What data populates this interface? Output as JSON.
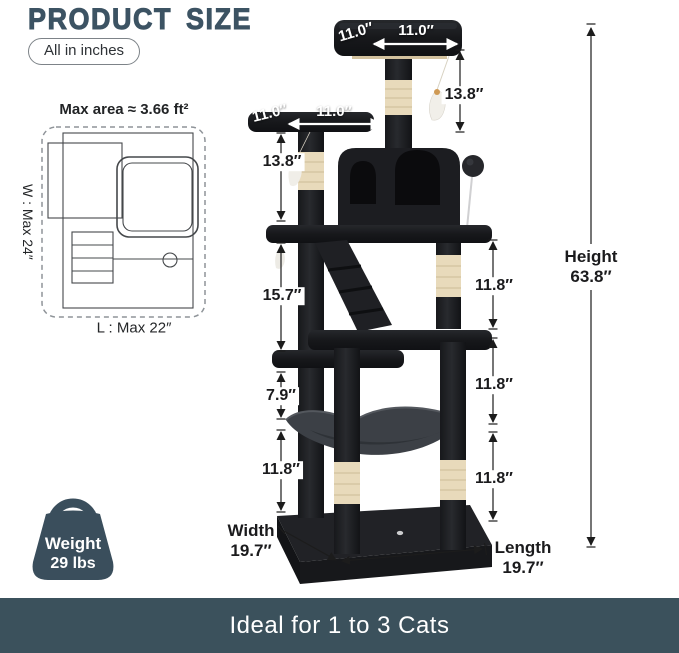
{
  "header": {
    "title": "PRODUCT SIZE",
    "units_badge": "All in inches"
  },
  "footprint": {
    "caption": "Max area ≈ 3.66 ft²",
    "width_label": "W : Max 24″",
    "length_label": "L : Max 22″"
  },
  "dimensions": {
    "top_perch_side": "11.0″",
    "top_perch_front": "11.0″",
    "upper_post": "13.8″",
    "side_perch_side": "11.0″",
    "side_perch_front": "11.0″",
    "side_post": "13.8″",
    "mid_section": "15.7″",
    "below_platform": "7.9″",
    "lower_left": "11.8″",
    "right_upper": "11.8″",
    "right_middle": "11.8″",
    "right_lower": "11.8″",
    "height_label": "Height",
    "height_value": "63.8″",
    "width_label": "Width",
    "width_value": "19.7″",
    "length_label": "Length",
    "length_value": "19.7″"
  },
  "weight": {
    "label": "Weight",
    "value": "29 lbs"
  },
  "footer": {
    "text": "Ideal for 1 to 3 Cats"
  },
  "colors": {
    "accent": "#3c5363",
    "banner": "#3b515c"
  }
}
